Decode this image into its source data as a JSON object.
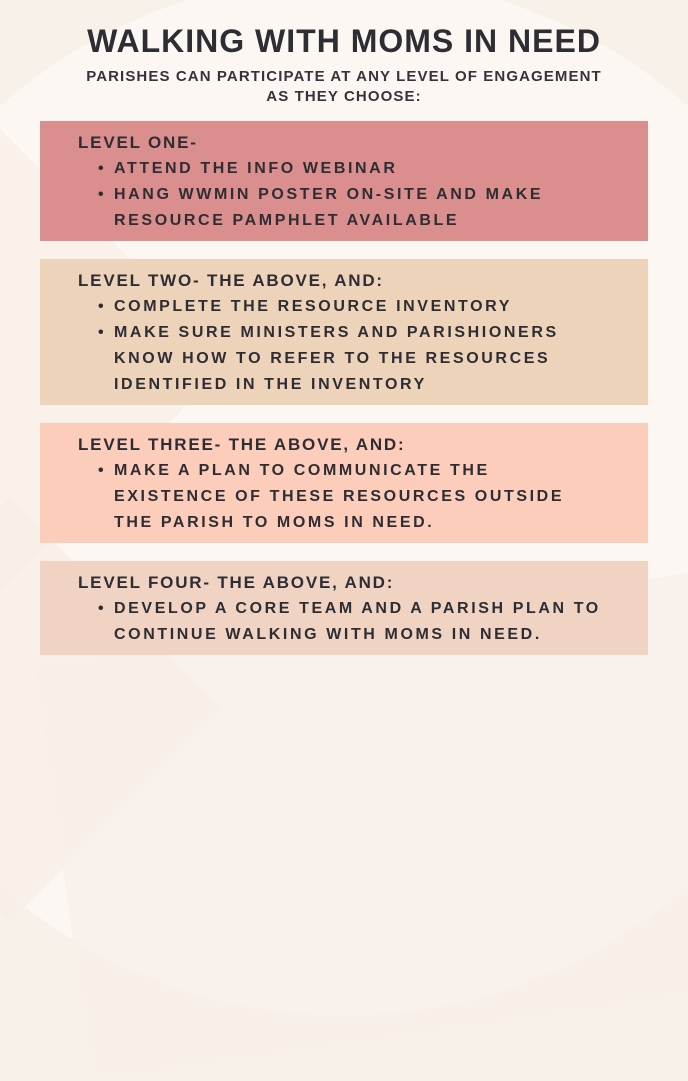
{
  "poster": {
    "title": "WALKING WITH MOMS IN NEED",
    "subtitle_line1": "PARISHES CAN PARTICIPATE AT ANY LEVEL OF ENGAGEMENT",
    "subtitle_line2": "AS THEY CHOOSE:",
    "levels": [
      {
        "heading": "LEVEL ONE-",
        "color": "#da8f8e",
        "bullets": [
          "ATTEND THE INFO WEBINAR",
          "HANG WWMIN POSTER ON-SITE AND MAKE RESOURCE PAMPHLET AVAILABLE"
        ]
      },
      {
        "heading": "LEVEL TWO- THE ABOVE, AND:",
        "color": "#eed3bb",
        "bullets": [
          "COMPLETE THE RESOURCE INVENTORY",
          "MAKE SURE MINISTERS AND PARISHIONERS KNOW HOW TO REFER TO THE RESOURCES IDENTIFIED IN THE INVENTORY"
        ]
      },
      {
        "heading": "LEVEL THREE- THE ABOVE, AND:",
        "color": "#fccdbb",
        "bullets": [
          "MAKE A PLAN TO COMMUNICATE THE EXISTENCE OF THESE RESOURCES OUTSIDE THE PARISH TO MOMS IN NEED."
        ]
      },
      {
        "heading": "LEVEL FOUR- THE ABOVE, AND:",
        "color": "#f0d3c3",
        "bullets": [
          "DEVELOP A CORE TEAM AND A PARISH PLAN TO CONTINUE WALKING WITH MOMS IN NEED."
        ]
      }
    ],
    "colors": {
      "background": "#f8f1ea",
      "background_light": "#fcf7f2",
      "text": "#2e2d33"
    }
  }
}
